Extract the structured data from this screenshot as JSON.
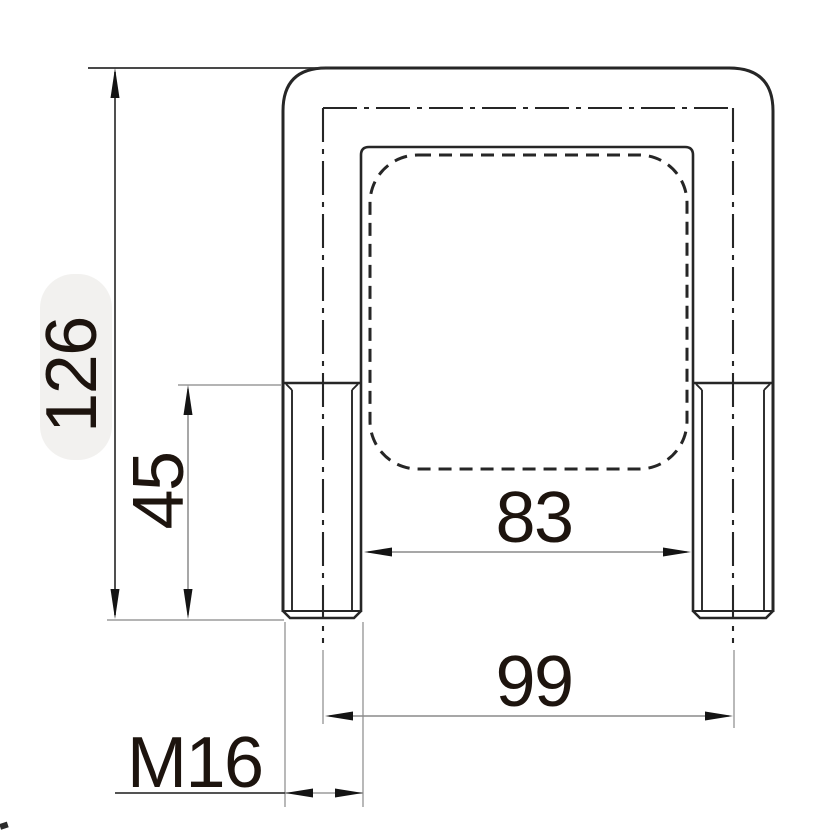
{
  "drawing": {
    "dimension_labels": {
      "overall_height": "126",
      "thread_length": "45",
      "inner_width": "83",
      "leg_center_spacing": "99",
      "thread_designation": "M16"
    },
    "colors": {
      "line": "#262626",
      "dim": "#8a8a8a",
      "text": "#1d140e",
      "highlight": "#f2f1ef"
    }
  }
}
